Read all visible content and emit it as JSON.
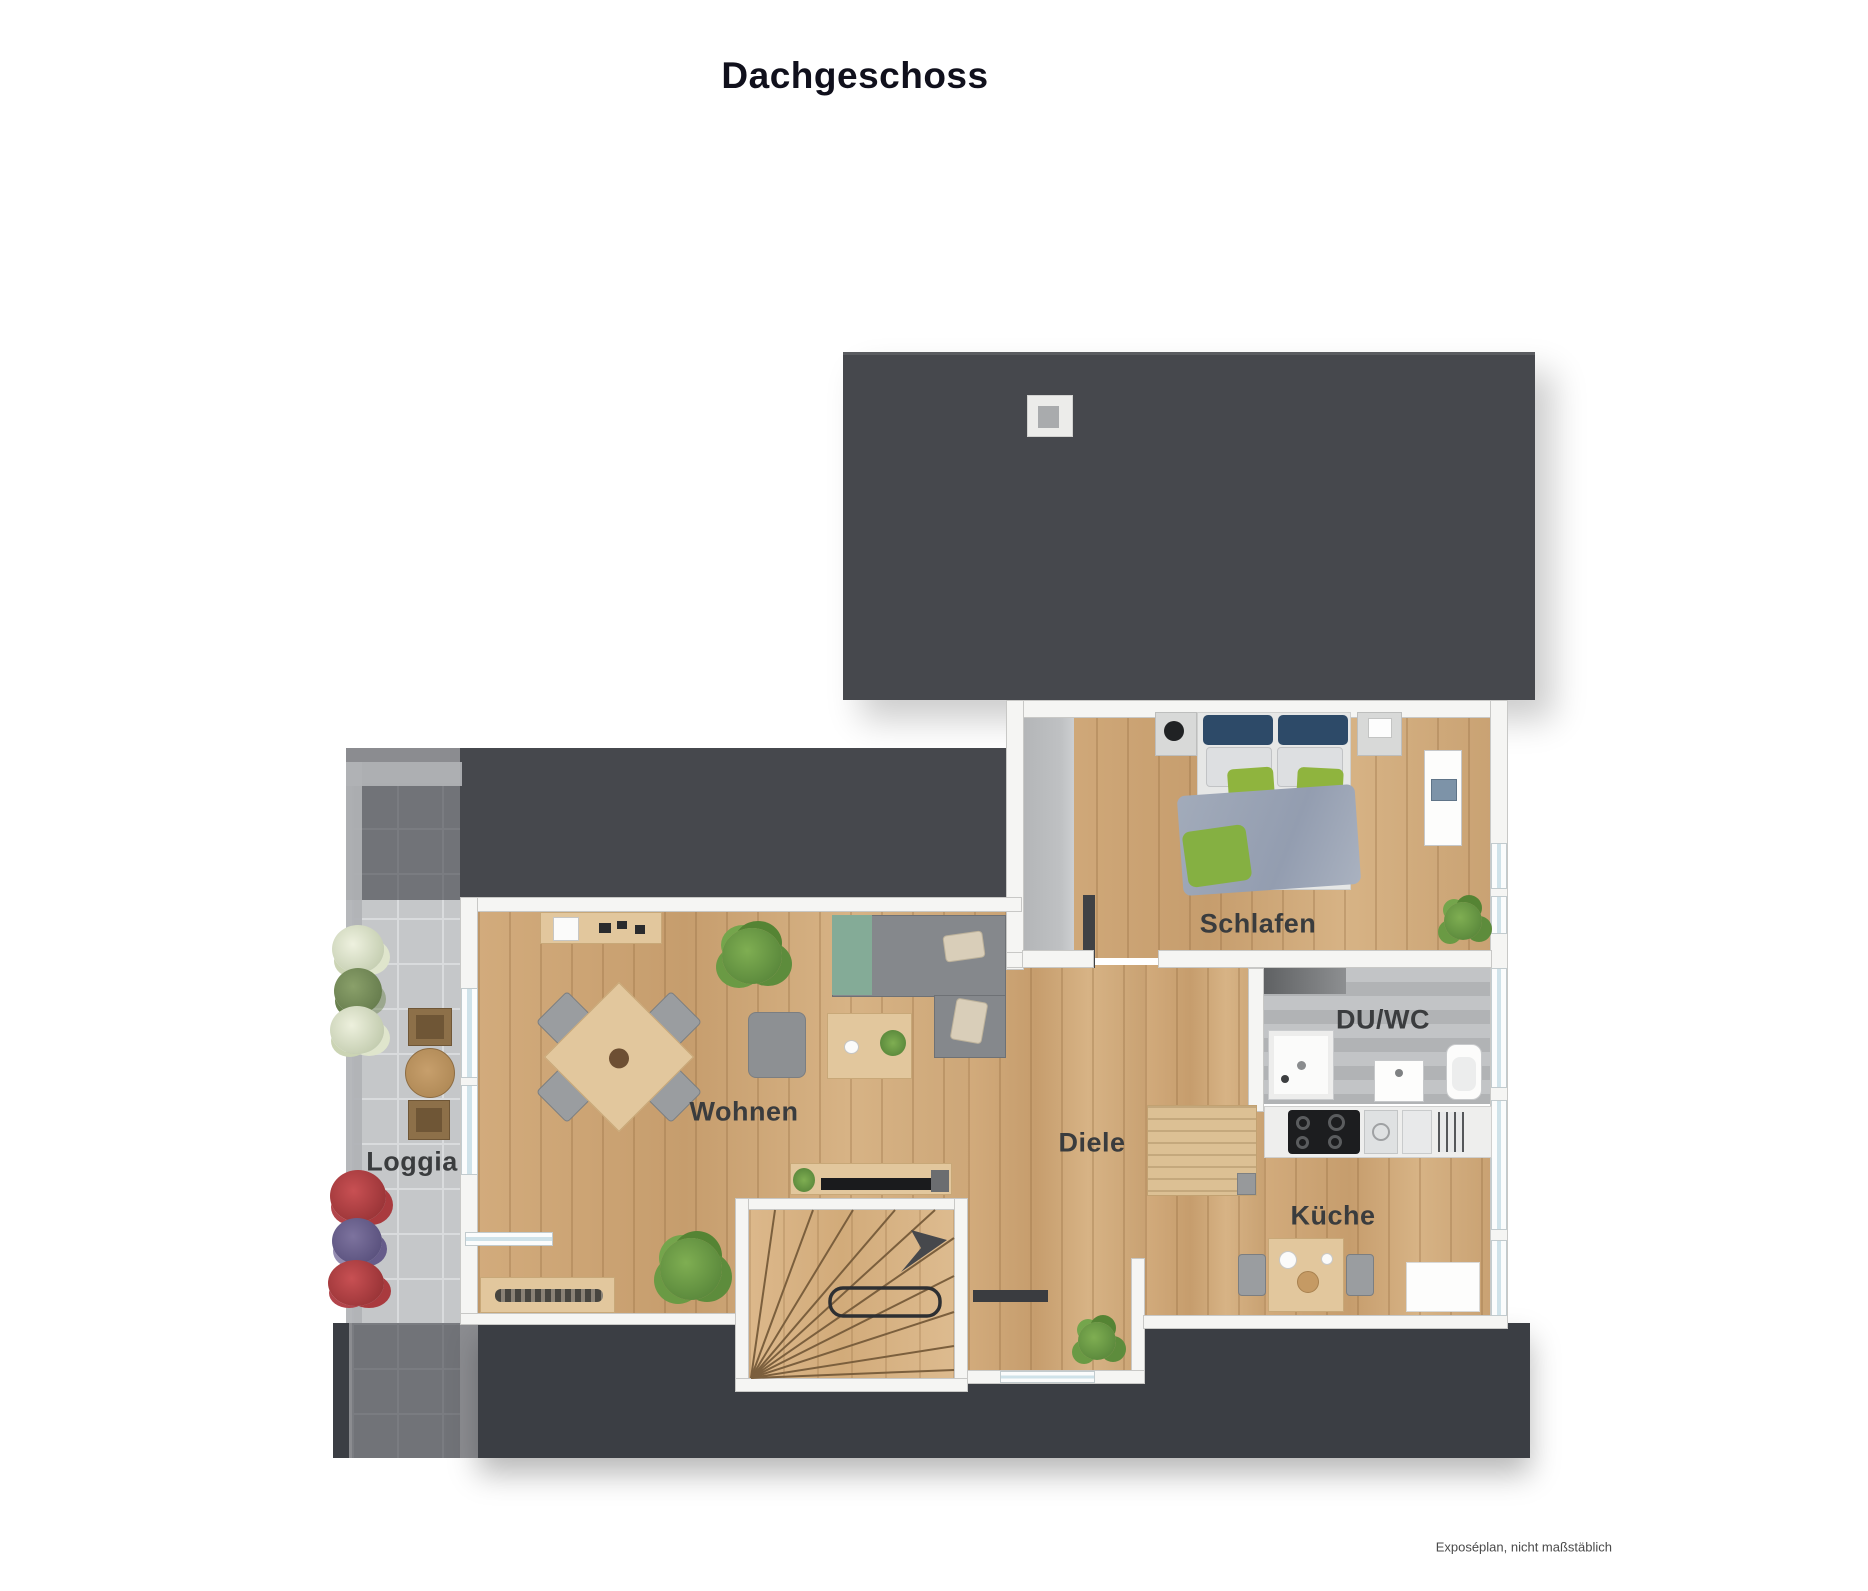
{
  "title": "Dachgeschoss",
  "footnote": "Exposéplan, nicht maßstäblich",
  "rooms": {
    "schlafen": "Schlafen",
    "du_wc": "DU/WC",
    "wohnen": "Wohnen",
    "diele": "Diele",
    "kueche": "Küche",
    "loggia": "Loggia"
  },
  "colors": {
    "roof_top": "#46484d",
    "roof_bottom": "#3b3e44",
    "wood_floor": "#cda677",
    "loggia_tile": "#c5c7c9",
    "bath_tile": "#b7b9bb",
    "wall": "#f5f5f3",
    "accent_green": "#8fb43e",
    "accent_navy": "#2d4a68",
    "label_text": "#3a3c3e"
  }
}
